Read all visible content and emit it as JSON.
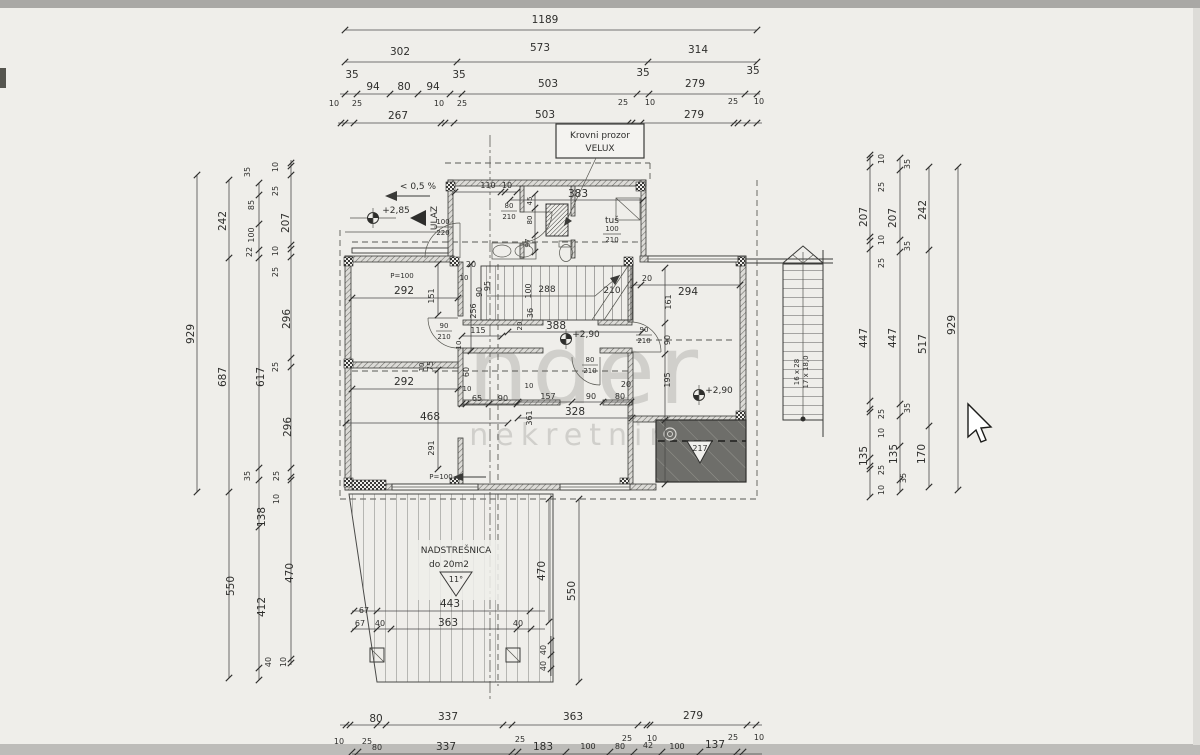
{
  "colors": {
    "paper": "#efeeea",
    "ink": "#3a3a38",
    "terrace": "#6e6e6a",
    "edge": "#a9a8a5"
  },
  "watermark": {
    "big": "nder",
    "small": "nekretnine"
  },
  "annot": {
    "krovni1": "Krovni prozor",
    "krovni2": "VELUX",
    "slope": "< 0,5 %",
    "ulaz": "ULAZ",
    "lvl1": "+2,85",
    "lvl2": "+2,90",
    "lvl3": "+2,90",
    "tus": "tuš",
    "nad1": "NADSTREŠNICA",
    "nad2": "do 20m2",
    "nad3": "11°",
    "terr": "217",
    "p100a": "P=100",
    "p100b": "P=100",
    "stair_note1": "16 x 28",
    "stair_note2": "17 x 18,0",
    "stair_len": "288",
    "stair_h": "210"
  },
  "fr": [
    [
      "80",
      "210"
    ],
    [
      "100",
      "220"
    ],
    [
      "90",
      "210"
    ],
    [
      "80",
      "210"
    ],
    [
      "90",
      "210"
    ],
    [
      "100",
      "210"
    ]
  ],
  "top": {
    "r1": [
      "1189"
    ],
    "r2": [
      "302",
      "573",
      "314"
    ],
    "r3": [
      "35",
      "94",
      "80",
      "94",
      "35",
      "503",
      "35",
      "279",
      "35"
    ],
    "r4": [
      "10",
      "25",
      "267",
      "10",
      "25",
      "503",
      "25",
      "10",
      "279",
      "25",
      "10"
    ]
  },
  "bottom": {
    "r1": [
      "10",
      "80",
      "25",
      "337",
      "25",
      "363",
      "25",
      "10",
      "279",
      "25",
      "10"
    ],
    "r2": [
      "80",
      "337",
      "183",
      "100",
      "80",
      "42",
      "100",
      "137"
    ]
  },
  "left": {
    "c1": [
      "929"
    ],
    "c2": [
      "242",
      "687",
      "550"
    ],
    "c3": [
      "35",
      "85",
      "100",
      "22",
      "617",
      "35",
      "138",
      "412",
      "40"
    ],
    "c4": [
      "10",
      "25",
      "207",
      "10",
      "25",
      "296",
      "25",
      "296",
      "25",
      "10",
      "470",
      "10"
    ]
  },
  "right": {
    "c1": [
      "10",
      "25",
      "207",
      "10",
      "25",
      "447",
      "25",
      "10",
      "135",
      "25",
      "10"
    ],
    "c2": [
      "35",
      "207",
      "35",
      "447",
      "35",
      "135",
      "35"
    ],
    "c3": [
      "242",
      "517",
      "170"
    ],
    "c4": [
      "929"
    ]
  },
  "inner": [
    "110",
    "10",
    "383",
    "45",
    "80",
    "97",
    "292",
    "151",
    "256",
    "95",
    "115",
    "75",
    "10",
    "60",
    "292",
    "10",
    "65",
    "90",
    "10",
    "157",
    "90",
    "80",
    "20",
    "328",
    "361",
    "468",
    "291",
    "100",
    "36",
    "20",
    "294",
    "161",
    "90",
    "195",
    "388",
    "470",
    "550",
    "67",
    "443",
    "67",
    "40",
    "363",
    "40",
    "40",
    "40",
    "20",
    "10",
    "90",
    "20",
    "10"
  ]
}
